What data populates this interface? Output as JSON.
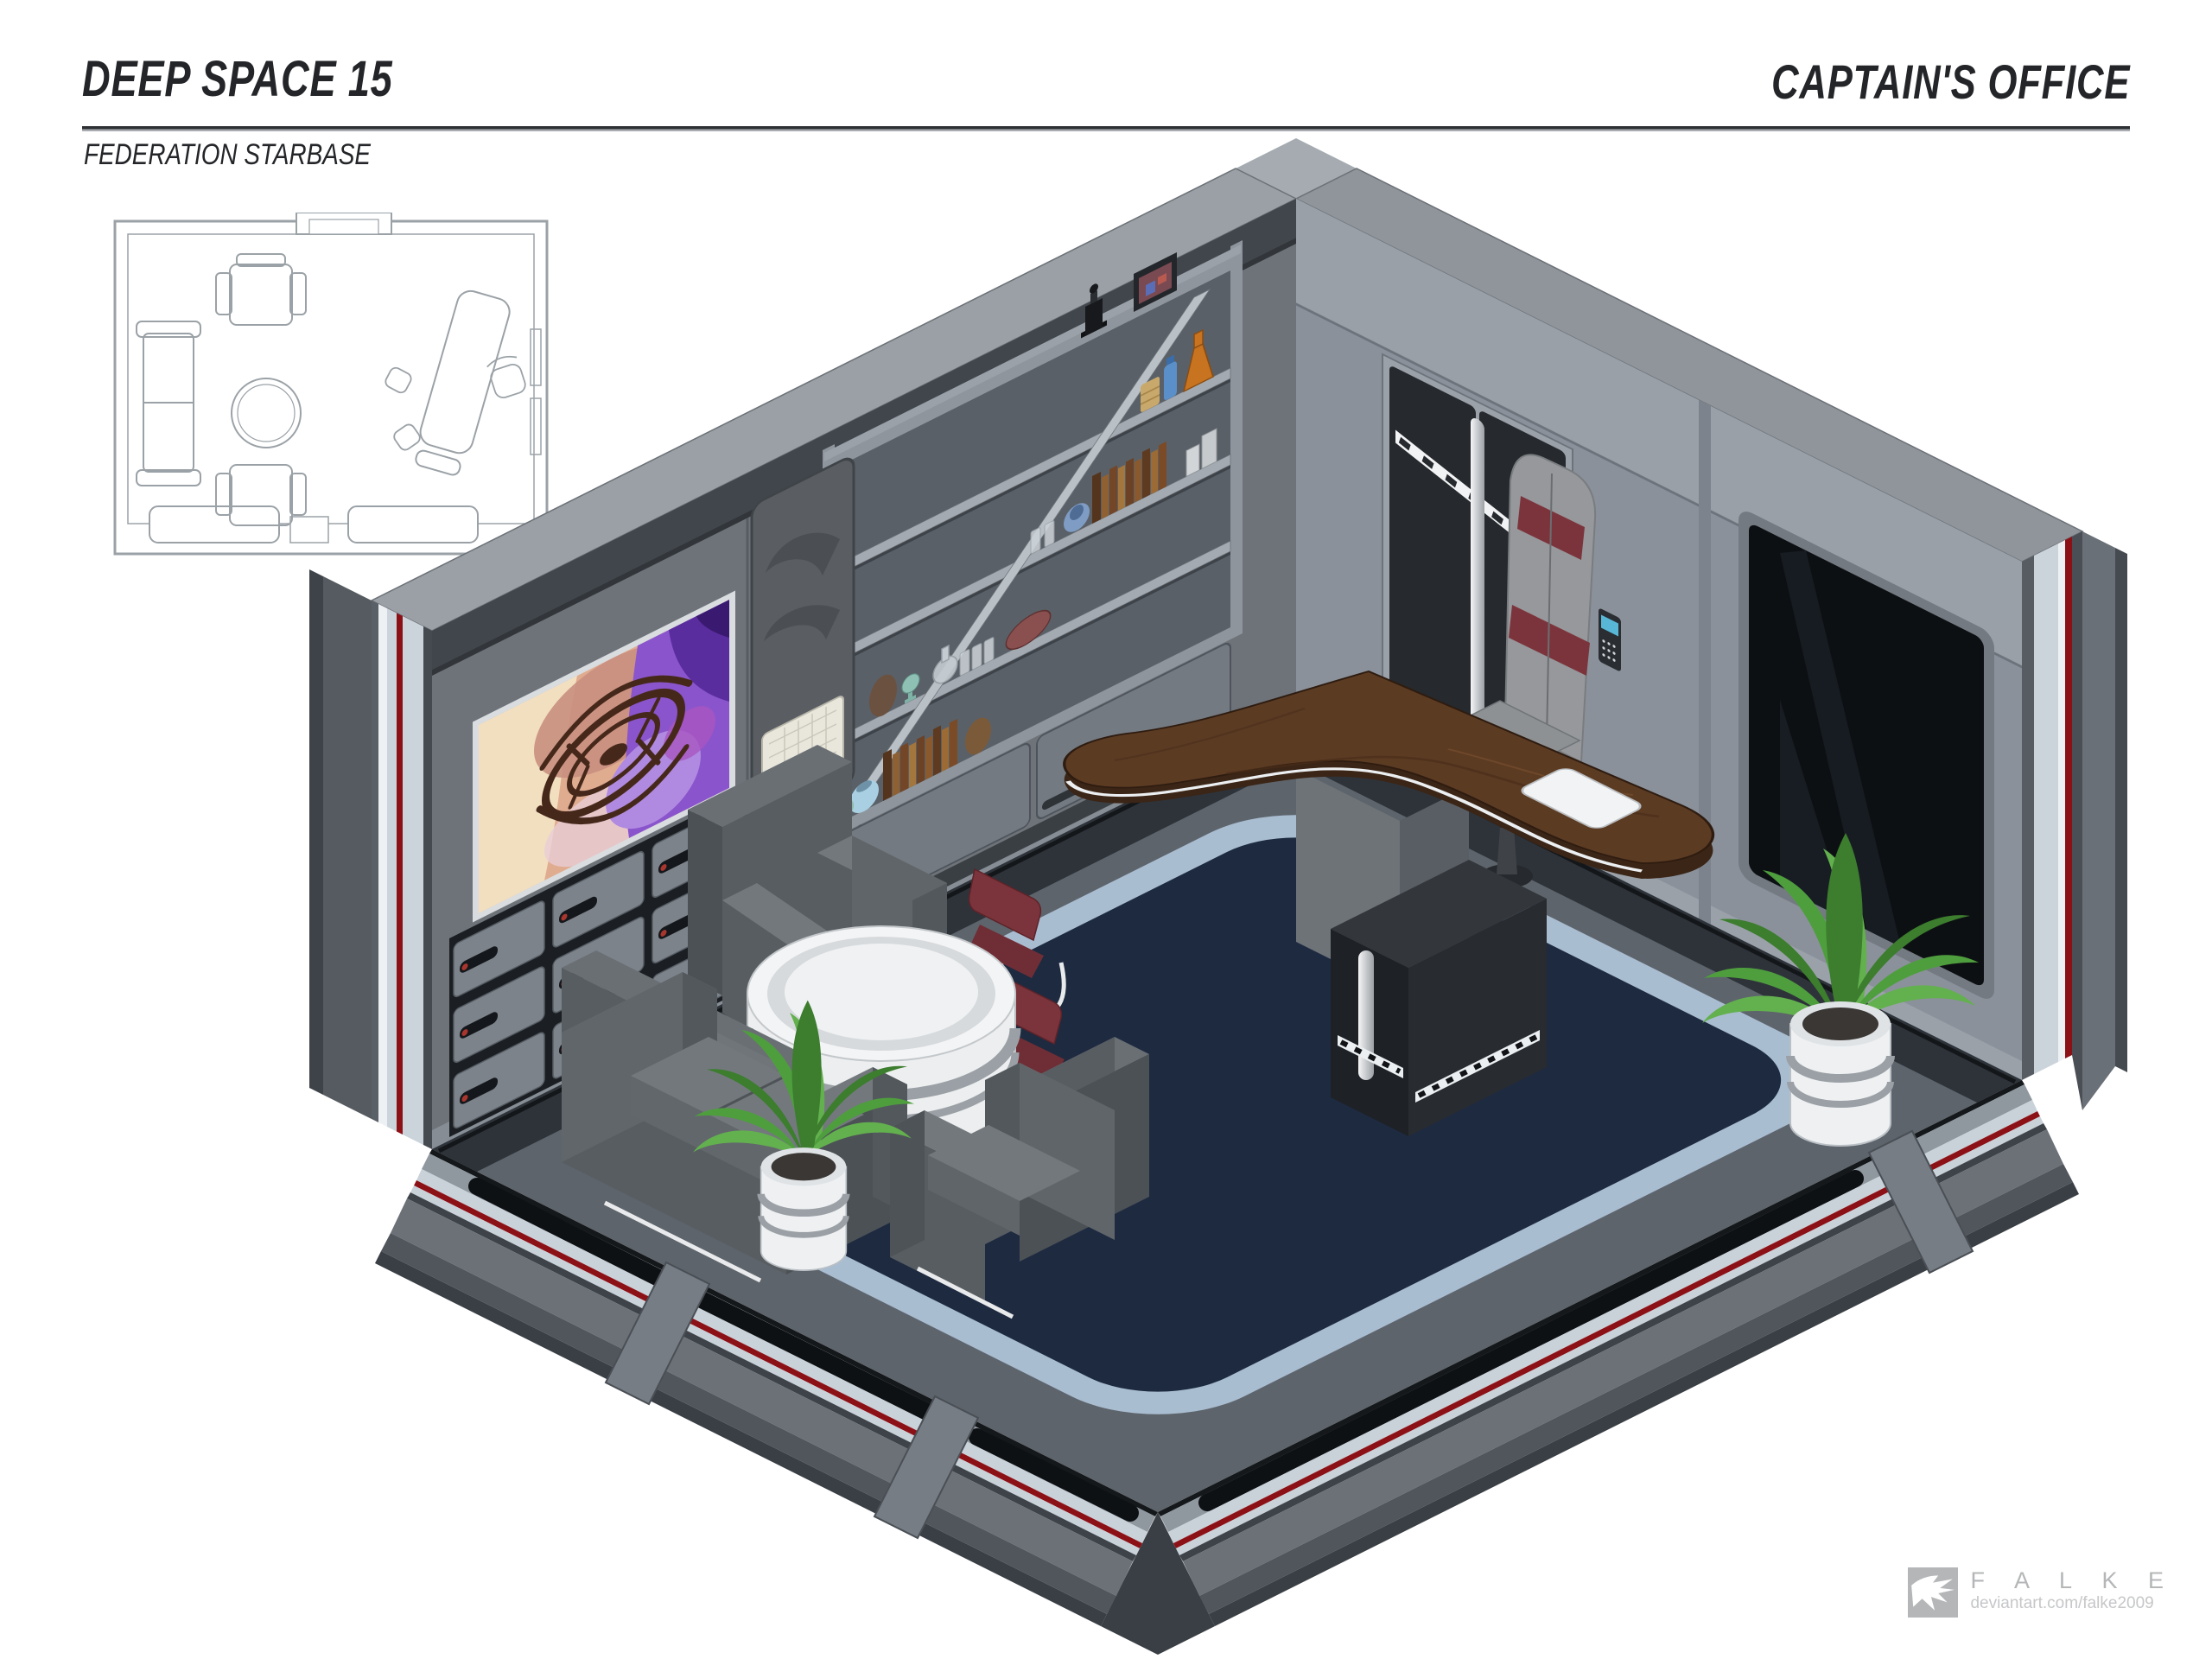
{
  "header": {
    "title": "DEEP SPACE 15",
    "subtitle": "FEDERATION STARBASE",
    "room_label": "CAPTAIN'S OFFICE"
  },
  "footer": {
    "artist_name": "F A L K E",
    "artist_url": "deviantart.com/falke2009"
  },
  "floor_plan": {
    "label": "top-down floor plan of the captain's office",
    "furniture": [
      "sofa",
      "armchair",
      "armchair",
      "round table",
      "executive desk",
      "desk chair",
      "guest chair",
      "guest chair",
      "doorway",
      "doorway"
    ]
  },
  "scene": {
    "label": "isometric cutaway illustration of the captain's office",
    "furniture": [
      "curved wooden executive desk",
      "white desk terminal",
      "gray executive chair with red bands",
      "red guest chair",
      "red guest chair",
      "black storage kiosk",
      "gray armchair",
      "gray armchair",
      "gray sofa",
      "white round table",
      "potted plant by desk",
      "potted plant in lounge"
    ],
    "wall_features": [
      "viewscreen artwork of space station",
      "drawer cabinets with red indicator dots",
      "shelving unit with diagonal brace",
      "wall sculpture panel with grid tray",
      "black double door with silver stripe",
      "door keypad",
      "dark window bay",
      "cutaway walls with red conduit"
    ],
    "shelf_items": [
      "framed photo",
      "black trophy bottle",
      "orange flask",
      "blue bottle",
      "tan jar",
      "drinking glasses",
      "rows of books",
      "blue pot",
      "metal canisters",
      "brown egg vase",
      "teal goblet",
      "glass decanter",
      "red ellipsoid artifact",
      "light blue pots",
      "brown jug"
    ]
  },
  "palette": {
    "page_bg": "#ffffff",
    "ink": "#232528",
    "rule_dark": "#2e3134",
    "logo_gray": "#b4b6b8",
    "logo_gray_light": "#c6c7c9",
    "plan_line": "#9ba2a7",
    "wall_top_band": "#9aa0a6",
    "wall_left": "#6e737a",
    "wall_right": "#8a919a",
    "wall_right_upper": "#99a0a8",
    "cornice_dark": "#41464c",
    "floor_platform": "#5d646b",
    "floor_strip_dark": "#2e333a",
    "carpet_border": "#a9bdd1",
    "carpet_navy": "#1d2a40",
    "cut_light": "#ccd4db",
    "cut_white": "#eef1f4",
    "conduit_red": "#8c1117",
    "cut_mid": "#6b7177",
    "cut_dark": "#3a3f45",
    "outer_wall": "#565b61",
    "door_dark": "#26292d",
    "door_frame": "#9ba1a9",
    "keypad_blue": "#58b7d6",
    "desk_wood": "#5c3b23",
    "desk_wood_dark": "#3b2516",
    "desk_base": "#6b7076",
    "terminal_white": "#f2f3f4",
    "kiosk_dark": "#1e2125",
    "chair_gray": "#96989b",
    "chair_red": "#7c343c",
    "wire_white": "#e8eaec",
    "sofa_top": "#73787d",
    "sofa_mid": "#6a6f74",
    "sofa_face": "#585d62",
    "sofa_side": "#4c5156",
    "table_white": "#f3f4f5",
    "band_gray": "#9aa0a5",
    "plant_green": "#4f9e3e",
    "plant_green_dark": "#3c7d2e",
    "plant_green_light": "#63b04e",
    "pot_white": "#eef0f2",
    "soil": "#3b3734",
    "art_cream": "#f2dfc0",
    "art_peach": "#e0ac90",
    "art_purple": "#8a55cc",
    "art_purple_deep": "#5a2d9e",
    "art_station": "#46281b"
  }
}
